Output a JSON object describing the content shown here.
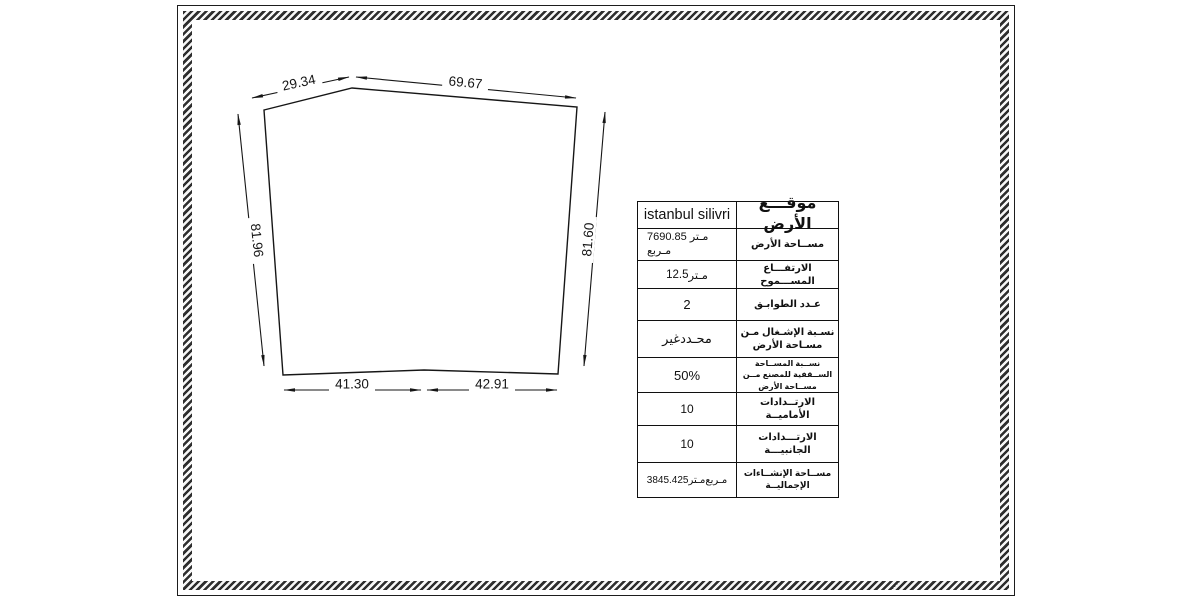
{
  "dimensions": {
    "top_left": "29.34",
    "top_right": "69.67",
    "side_left": "81.96",
    "side_right": "81.60",
    "bottom_left": "41.30",
    "bottom_right": "42.91"
  },
  "info_table": {
    "rows": [
      {
        "label": "موقـــع الأرض",
        "value": "istanbul silivri"
      },
      {
        "label": "مســاحة الأرض",
        "value": "7690.85 مـتر مـربع"
      },
      {
        "label": "الارتفـــاع المســـموح",
        "value": "12.5 مـتر"
      },
      {
        "label": "عـدد الطوابـق",
        "value": "2"
      },
      {
        "label": "نسـبة الإشـغال مـن مسـاحة الأرض",
        "value": "غير محـدد"
      },
      {
        "label": "نســبة المســاحة الســقفية للمصنع مــن مســاحة الأرض",
        "value": "50%"
      },
      {
        "label": "الارتــدادات الأماميــة",
        "value": "10"
      },
      {
        "label": "الارتـــدادات الجانبيـــة",
        "value": "10"
      },
      {
        "label": "مســاحة الإنشــاءات الإجماليــة",
        "value": "3845.425 مـتر مـربع"
      }
    ]
  }
}
